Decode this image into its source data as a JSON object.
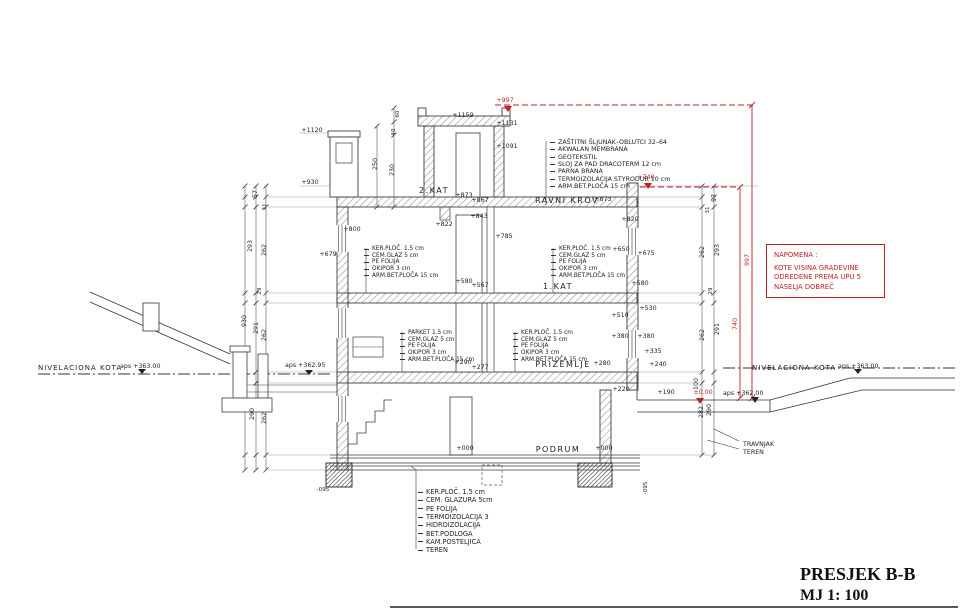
{
  "title_block": {
    "title": "PRESJEK B-B",
    "scale": "MJ 1: 100"
  },
  "note_box": {
    "lines": [
      "NAPOMENA :",
      "KOTE VISINA GRADEVINE",
      "ODREDENE PREMA UPU 5",
      "NASELJA DOBREČ"
    ]
  },
  "colors": {
    "annotation_red": "#c41f1f",
    "line_dark": "#333333"
  },
  "legends": {
    "roof": [
      "ZAŠTITNI ŠLJUNAK–OBLUTCI 32–64",
      "AKWALAN MEMBRANA",
      "GEOTEKSTIL",
      "SLOJ ZA PAD DRACOTERM 12 cm",
      "PARNA BRANA",
      "TERMOIZOLACIJA STYRODUR 10 cm",
      "ARM.BET.PLOČA 15 cm"
    ],
    "floor_tile": [
      "KER.PLOČ. 1.5 cm",
      "CEM.GLAZ 5 cm",
      "PE FOLIJA",
      "OKIPOR 3 cm",
      "ARM.BET.PLOČA 15 cm"
    ],
    "floor_parket": [
      "PARKET 1.5 cm",
      "CEM.GLAZ 5 cm",
      "PE FOLIJA",
      "OKIPOR 3 cm",
      "ARM.BET.PLOČA 15 cm"
    ],
    "foundation": [
      "KER.PLOČ. 1.5 cm",
      "CEM. GLAZURA 5cm",
      "PE FOLIJA",
      "TERMOIZOLACIJA 3",
      "HIDROIZOLACIJA",
      "BET.PODLOGA",
      "KAM.POSTELJICA",
      "TEREN"
    ]
  },
  "annotations": [
    {
      "name": "level-1120",
      "text": "+1120",
      "x": 312,
      "y": 132
    },
    {
      "name": "level-930",
      "text": "+930",
      "x": 310,
      "y": 184
    },
    {
      "name": "level-1159",
      "text": "+1159",
      "x": 463,
      "y": 117
    },
    {
      "name": "level-1131",
      "text": "+1131",
      "x": 507,
      "y": 125
    },
    {
      "name": "level-1091",
      "text": "+1091",
      "x": 507,
      "y": 148
    },
    {
      "name": "level-997",
      "text": "+997",
      "x": 505,
      "y": 102,
      "cls": "red"
    },
    {
      "name": "level-740",
      "text": "+740",
      "x": 646,
      "y": 179,
      "cls": "red"
    },
    {
      "name": "dim-250",
      "text": "250",
      "x": 377,
      "y": 164,
      "rot": -90
    },
    {
      "name": "dim-230",
      "text": "230",
      "x": 394,
      "y": 170,
      "rot": -90
    },
    {
      "name": "dim-60",
      "text": "60",
      "x": 399,
      "y": 114,
      "rot": -90,
      "cls": "sm"
    },
    {
      "name": "dim-40",
      "text": "40",
      "x": 395,
      "y": 132,
      "rot": -90,
      "cls": "sm"
    },
    {
      "name": "room-2kat",
      "text": "2.KAT",
      "x": 434,
      "y": 193,
      "cls": "room"
    },
    {
      "name": "room-ravni-krov",
      "text": "RAVNI KROV",
      "x": 567,
      "y": 203,
      "cls": "room"
    },
    {
      "name": "level-873-roof",
      "text": "+873",
      "x": 603,
      "y": 201
    },
    {
      "name": "level-873",
      "text": "+873",
      "x": 464,
      "y": 197
    },
    {
      "name": "level-867",
      "text": "+867",
      "x": 480,
      "y": 202
    },
    {
      "name": "level-822",
      "text": "+822",
      "x": 444,
      "y": 226
    },
    {
      "name": "level-843",
      "text": "+843",
      "x": 479,
      "y": 218
    },
    {
      "name": "level-785",
      "text": "+785",
      "x": 504,
      "y": 238
    },
    {
      "name": "level-800",
      "text": "+800",
      "x": 352,
      "y": 231
    },
    {
      "name": "level-820",
      "text": "+820",
      "x": 630,
      "y": 221
    },
    {
      "name": "level-650",
      "text": "+650",
      "x": 621,
      "y": 251
    },
    {
      "name": "level-675",
      "text": "+675",
      "x": 646,
      "y": 255
    },
    {
      "name": "level-679",
      "text": "+679",
      "x": 328,
      "y": 256
    },
    {
      "name": "room-1kat",
      "text": "1.KAT",
      "x": 558,
      "y": 289,
      "cls": "room"
    },
    {
      "name": "level-580-left",
      "text": "+580",
      "x": 464,
      "y": 283
    },
    {
      "name": "level-567",
      "text": "+567",
      "x": 480,
      "y": 287
    },
    {
      "name": "level-580-right",
      "text": "+580",
      "x": 640,
      "y": 285
    },
    {
      "name": "level-510",
      "text": "+510",
      "x": 620,
      "y": 317
    },
    {
      "name": "level-530",
      "text": "+530",
      "x": 648,
      "y": 310
    },
    {
      "name": "level-380-a",
      "text": "+380",
      "x": 620,
      "y": 338
    },
    {
      "name": "level-380-b",
      "text": "+380",
      "x": 646,
      "y": 338
    },
    {
      "name": "level-335",
      "text": "+335",
      "x": 653,
      "y": 353
    },
    {
      "name": "level-240",
      "text": "+240",
      "x": 658,
      "y": 366
    },
    {
      "name": "room-prizemlje",
      "text": "PRIZEMLJE",
      "x": 563,
      "y": 367,
      "cls": "room"
    },
    {
      "name": "level-280",
      "text": "+280",
      "x": 602,
      "y": 365
    },
    {
      "name": "level-290",
      "text": "+290",
      "x": 463,
      "y": 364
    },
    {
      "name": "level-277",
      "text": "+277",
      "x": 480,
      "y": 369
    },
    {
      "name": "level-220",
      "text": "+220",
      "x": 621,
      "y": 391
    },
    {
      "name": "level-190",
      "text": "+190",
      "x": 666,
      "y": 394
    },
    {
      "name": "dim-100",
      "text": "100",
      "x": 698,
      "y": 384,
      "rot": -90
    },
    {
      "name": "level-zero",
      "text": "±0.00",
      "x": 703,
      "y": 394,
      "cls": "red"
    },
    {
      "name": "aps-362-00",
      "text": "aps +362.00",
      "x": 723,
      "y": 395,
      "cls": "start"
    },
    {
      "name": "niv-left-label",
      "text": "NIVELACIONA KOTA",
      "x": 38,
      "y": 370,
      "cls": "niv"
    },
    {
      "name": "niv-left-value",
      "text": "aps +363.00",
      "x": 120,
      "y": 368,
      "cls": "start"
    },
    {
      "name": "niv-right-label",
      "text": "NIVELACIONA KOTA",
      "x": 752,
      "y": 370,
      "cls": "niv"
    },
    {
      "name": "niv-right-value",
      "text": "aps +363.00",
      "x": 838,
      "y": 368,
      "cls": "start"
    },
    {
      "name": "aps-362-95",
      "text": "aps +362.95",
      "x": 285,
      "y": 367,
      "cls": "start"
    },
    {
      "name": "room-podrum",
      "text": "PODRUM",
      "x": 558,
      "y": 452,
      "cls": "room"
    },
    {
      "name": "level-000-left",
      "text": "+000",
      "x": 465,
      "y": 450
    },
    {
      "name": "level-000-right",
      "text": "+000",
      "x": 604,
      "y": 450
    },
    {
      "name": "dim-997",
      "text": "997",
      "x": 749,
      "y": 260,
      "rot": -90,
      "cls": "red"
    },
    {
      "name": "dim-740",
      "text": "740",
      "x": 737,
      "y": 324,
      "rot": -90,
      "cls": "red"
    },
    {
      "name": "dim-57-left",
      "text": "57",
      "x": 257,
      "y": 194,
      "rot": -90
    },
    {
      "name": "dim-31-left",
      "text": "31",
      "x": 266,
      "y": 207,
      "rot": -90,
      "cls": "sm"
    },
    {
      "name": "dim-293-left",
      "text": "293",
      "x": 252,
      "y": 246,
      "rot": -90
    },
    {
      "name": "dim-262-left-a",
      "text": "262",
      "x": 266,
      "y": 250,
      "rot": -90
    },
    {
      "name": "dim-29-left",
      "text": "29",
      "x": 261,
      "y": 291,
      "rot": -90,
      "cls": "sm"
    },
    {
      "name": "dim-930",
      "text": "930",
      "x": 246,
      "y": 321,
      "rot": -90
    },
    {
      "name": "dim-291-left",
      "text": "291",
      "x": 258,
      "y": 328,
      "rot": -90
    },
    {
      "name": "dim-262-left-b",
      "text": "262",
      "x": 266,
      "y": 335,
      "rot": -90
    },
    {
      "name": "dim-290-left",
      "text": "290",
      "x": 254,
      "y": 414,
      "rot": -90
    },
    {
      "name": "dim-262-left-c",
      "text": "262",
      "x": 266,
      "y": 418,
      "rot": -90
    },
    {
      "name": "dim-57-right",
      "text": "57",
      "x": 716,
      "y": 198,
      "rot": -90
    },
    {
      "name": "dim-31-right",
      "text": "31",
      "x": 709,
      "y": 210,
      "rot": -90,
      "cls": "sm"
    },
    {
      "name": "dim-293-right",
      "text": "293",
      "x": 719,
      "y": 250,
      "rot": -90
    },
    {
      "name": "dim-262-right-a",
      "text": "262",
      "x": 704,
      "y": 252,
      "rot": -90
    },
    {
      "name": "dim-29-right",
      "text": "29",
      "x": 712,
      "y": 291,
      "rot": -90,
      "cls": "sm"
    },
    {
      "name": "dim-291-right",
      "text": "291",
      "x": 719,
      "y": 329,
      "rot": -90
    },
    {
      "name": "dim-262-right-b",
      "text": "262",
      "x": 704,
      "y": 335,
      "rot": -90
    },
    {
      "name": "dim-282",
      "text": "282",
      "x": 703,
      "y": 412,
      "rot": -90
    },
    {
      "name": "dim-290-right",
      "text": "290",
      "x": 711,
      "y": 410,
      "rot": -90
    },
    {
      "name": "label-travnjak",
      "text": "TRAVNJAK",
      "x": 743,
      "y": 446,
      "cls": "start"
    },
    {
      "name": "label-teren",
      "text": "TEREN",
      "x": 743,
      "y": 454,
      "cls": "start"
    },
    {
      "name": "level-m095-left",
      "text": "-095",
      "x": 323,
      "y": 491,
      "cls": "sm"
    },
    {
      "name": "level-m095-right",
      "text": "-095",
      "x": 647,
      "y": 488,
      "rot": -90,
      "cls": "sm"
    }
  ]
}
